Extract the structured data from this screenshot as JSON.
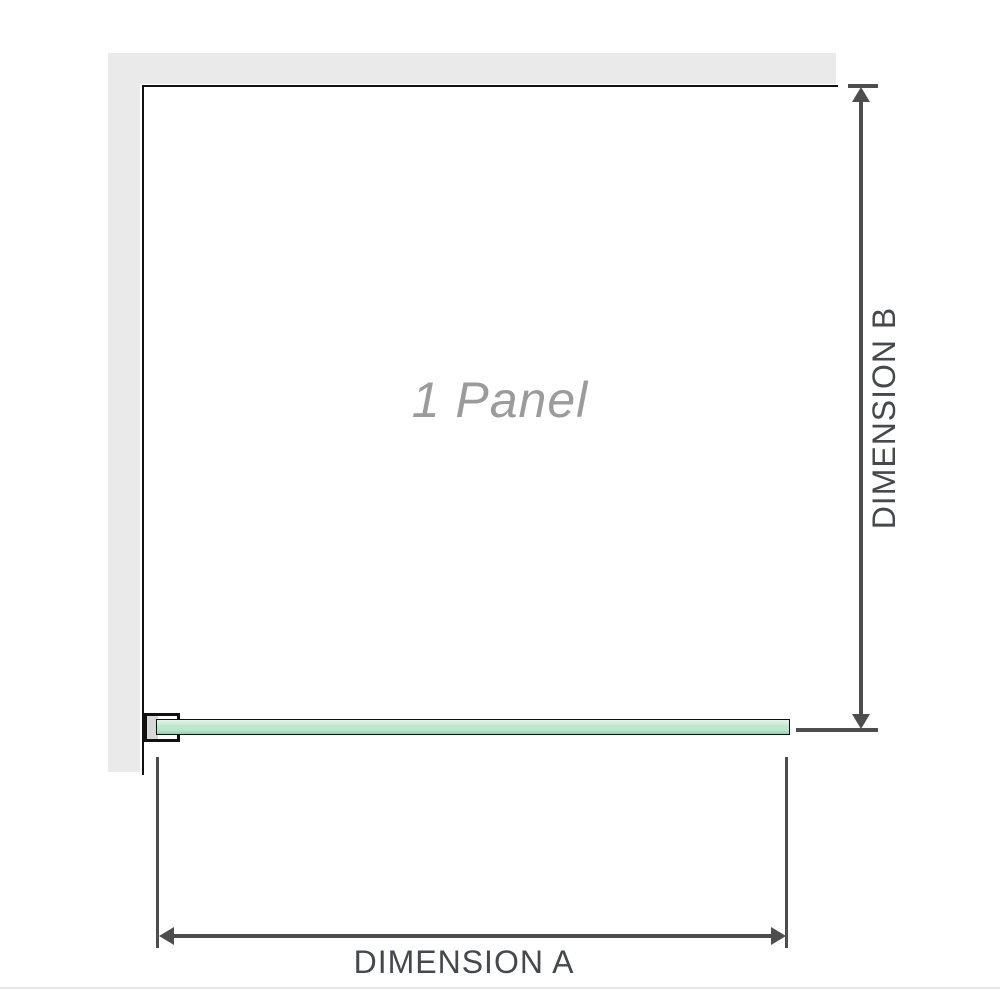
{
  "diagram": {
    "panel_label": "1 Panel",
    "dimension_a_label": "DIMENSION A",
    "dimension_b_label": "DIMENSION B"
  },
  "colors": {
    "background": "#ffffff",
    "wall": "#eaeaea",
    "outline": "#111111",
    "glass_light": "#e4f4ea",
    "glass_mid": "#bce7cd",
    "glass_dark": "#8bd3a9",
    "bracket_fill": "#d8d8d8",
    "dimension_line": "#4d4d4d",
    "dimension_text": "#45484c",
    "panel_text": "#9b9b9b",
    "baseline_rule": "#e9e5df"
  }
}
